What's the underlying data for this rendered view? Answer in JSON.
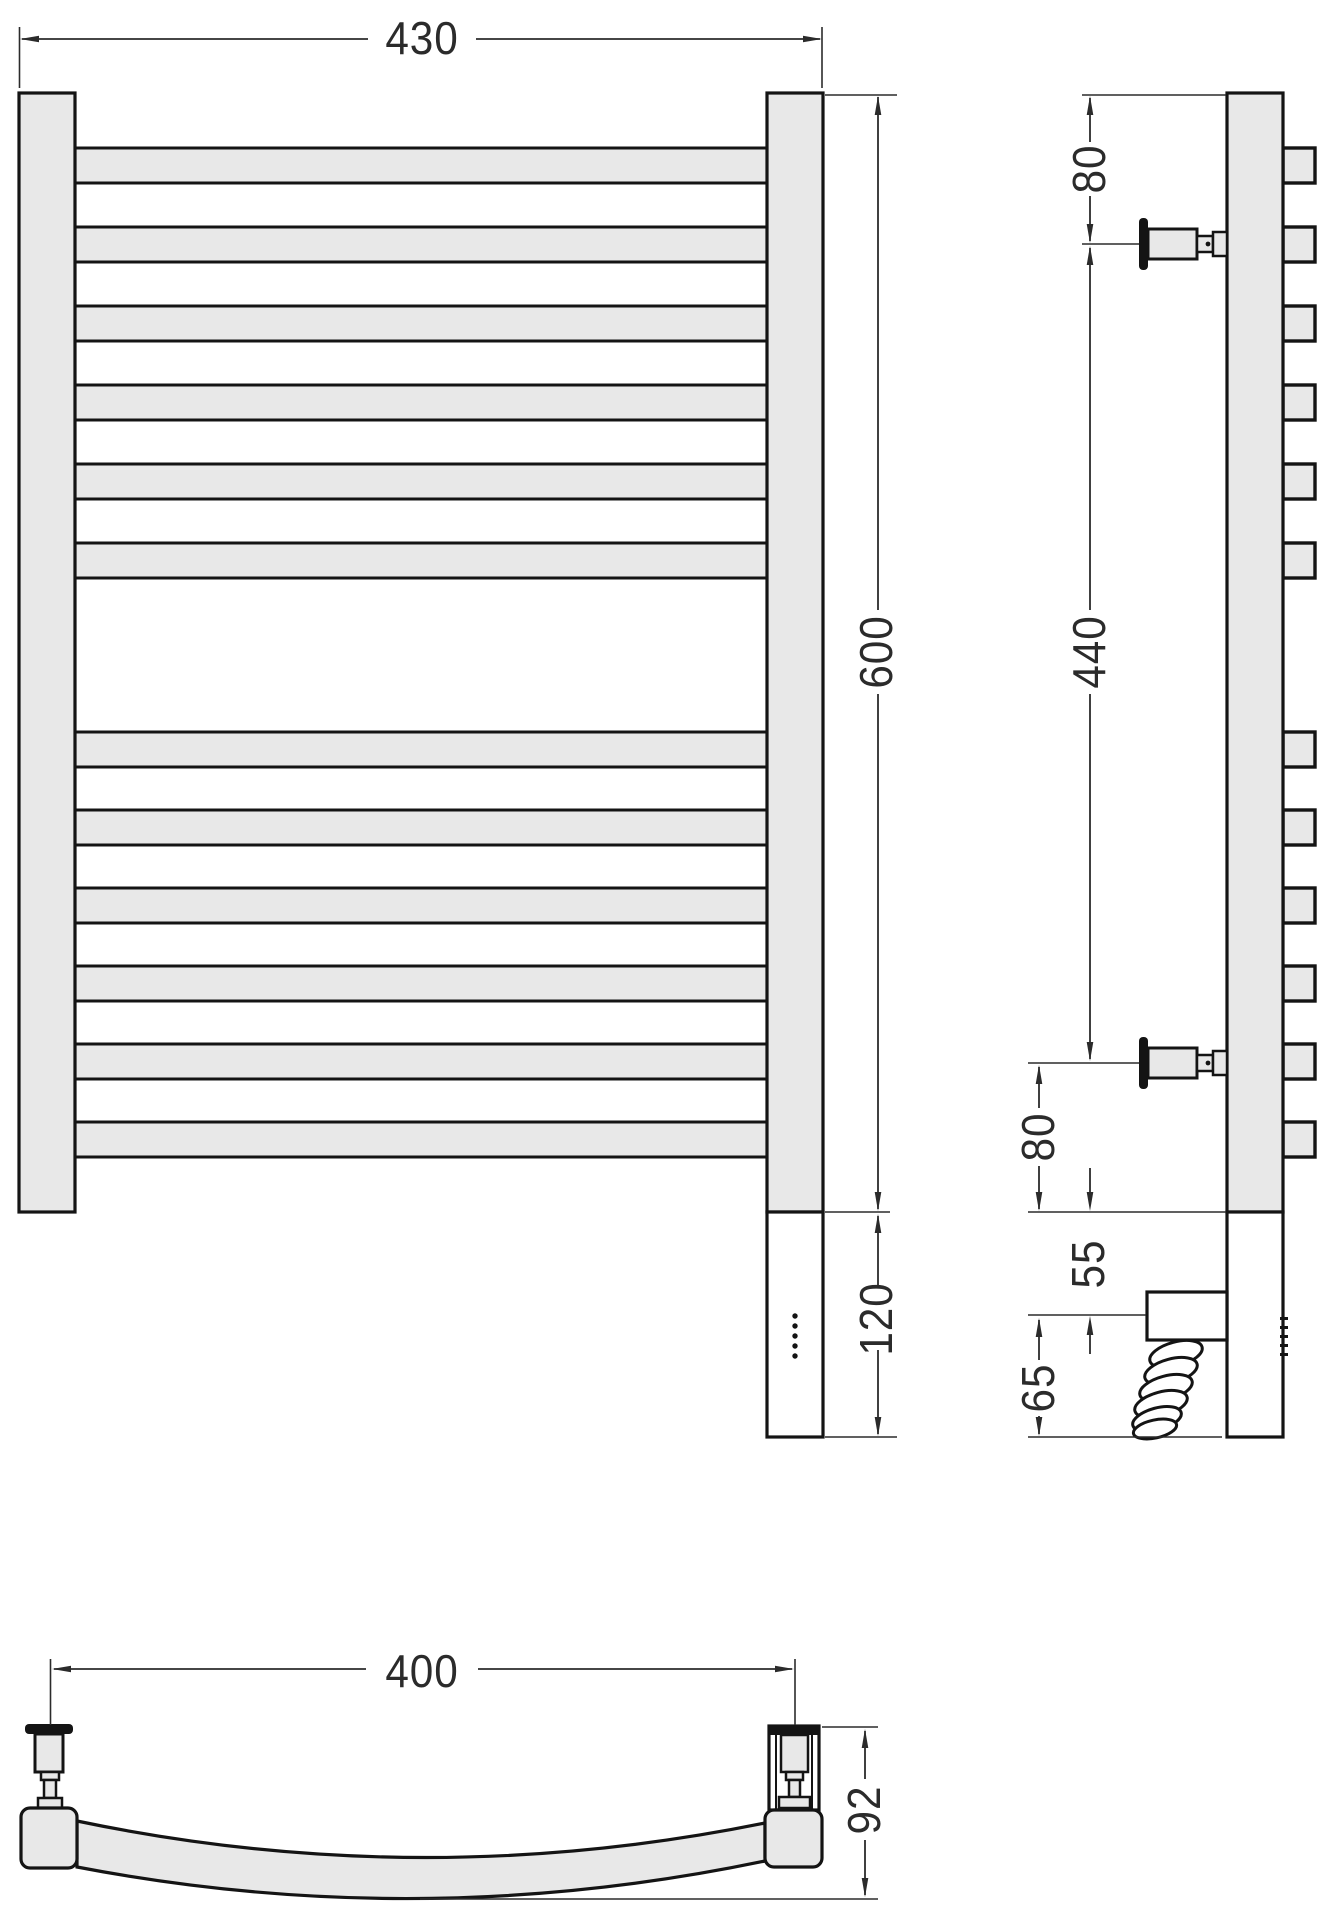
{
  "drawing": {
    "background": "#ffffff",
    "outline_color": "#141414",
    "dimension_color": "#2b2b2b",
    "part_fill": "#e8e8e8",
    "front_view": {
      "bars_top_group": 6,
      "bars_bottom_group": 6,
      "indicator_dots": 5,
      "dimensions": {
        "overall_width": "430",
        "rail_height": "600",
        "heater_section_height": "120"
      }
    },
    "side_view": {
      "dimensions": {
        "top_to_bracket": "80",
        "bracket_span": "440",
        "bracket_to_bottom": "80",
        "bottom_to_heater_axis": "55",
        "heater_axis_to_end": "65"
      }
    },
    "bottom_view": {
      "dimensions": {
        "valve_axis_spacing": "400",
        "overall_depth": "92"
      }
    }
  }
}
